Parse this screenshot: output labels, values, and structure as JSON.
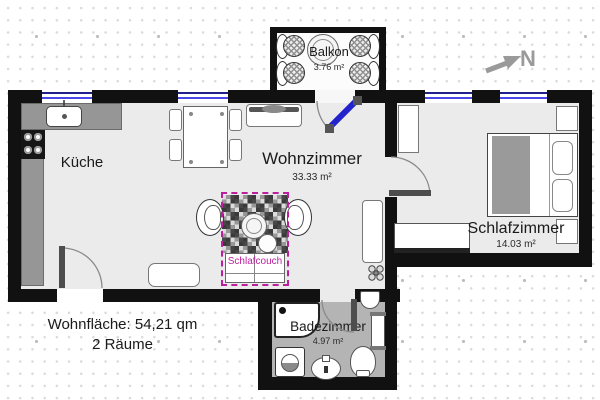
{
  "rooms": {
    "balkon": {
      "name": "Balkon",
      "area": "3.76 m²"
    },
    "kueche": {
      "name": "Küche"
    },
    "wohnzimmer": {
      "name": "Wohnzimmer",
      "area": "33.33 m²"
    },
    "schlafzimmer": {
      "name": "Schlafzimmer",
      "area": "14.03 m²"
    },
    "badezimmer": {
      "name": "Badezimmer",
      "area": "4.97 m²"
    }
  },
  "annotations": {
    "schlafcouch_label": "Schlafcouch",
    "compass_label": "N",
    "summary_line1": "Wohnfläche: 54,21 qm",
    "summary_line2": "2 Räume"
  },
  "colors": {
    "wall": "#111111",
    "floor": "#ebebeb",
    "bath_floor": "#b4b4b4",
    "window_blue": "#4848e8",
    "door_blue": "#2323cd",
    "accent_magenta": "#bb1f9e",
    "compass_gray": "#9a9a9a"
  }
}
